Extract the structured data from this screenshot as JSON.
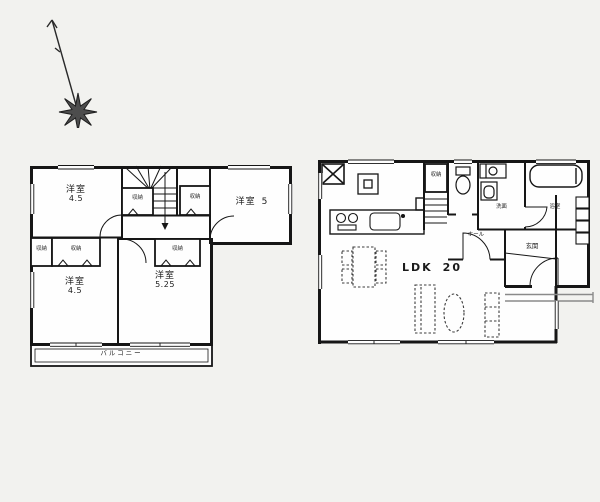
{
  "palette": {
    "background": "#f2f2ef",
    "wall_line": "#161616",
    "floor_fill": "#fefefe",
    "furniture_dash": "#3c3c3c"
  },
  "icons": {
    "compass": "north-arrow-icon",
    "stairs": "stairs-icon",
    "toilet": "toilet-icon",
    "bathtub": "bathtub-icon",
    "kitchen_sink": "kitchen-sink-icon",
    "stove": "stove-icon",
    "refrigerator": "refrigerator-x-icon",
    "dining_set": "dining-table-icon",
    "sofa": "sofa-icon",
    "low_table": "oval-table-icon"
  },
  "floor2": {
    "room_top_left": {
      "label": "洋室",
      "size": "4.5"
    },
    "room_top_right": {
      "label": "洋室",
      "size": "5"
    },
    "room_bottom_left": {
      "label": "洋室",
      "size": "4.5"
    },
    "room_bottom_right": {
      "label": "洋室",
      "size": "5.25"
    },
    "closet_stair_left": "収納",
    "closet_stair_right": "収納",
    "closet_row_small": "収納",
    "closet_row_wide": "収納",
    "closet_bottom_right": "収納",
    "balcony_label": "バルコニー"
  },
  "floor1": {
    "ldk": {
      "label": "LDK",
      "size": "20"
    },
    "stair_closet": "収納",
    "washroom": "洗面",
    "bath": "浴室",
    "hall": "ホール",
    "entrance": "玄関"
  }
}
